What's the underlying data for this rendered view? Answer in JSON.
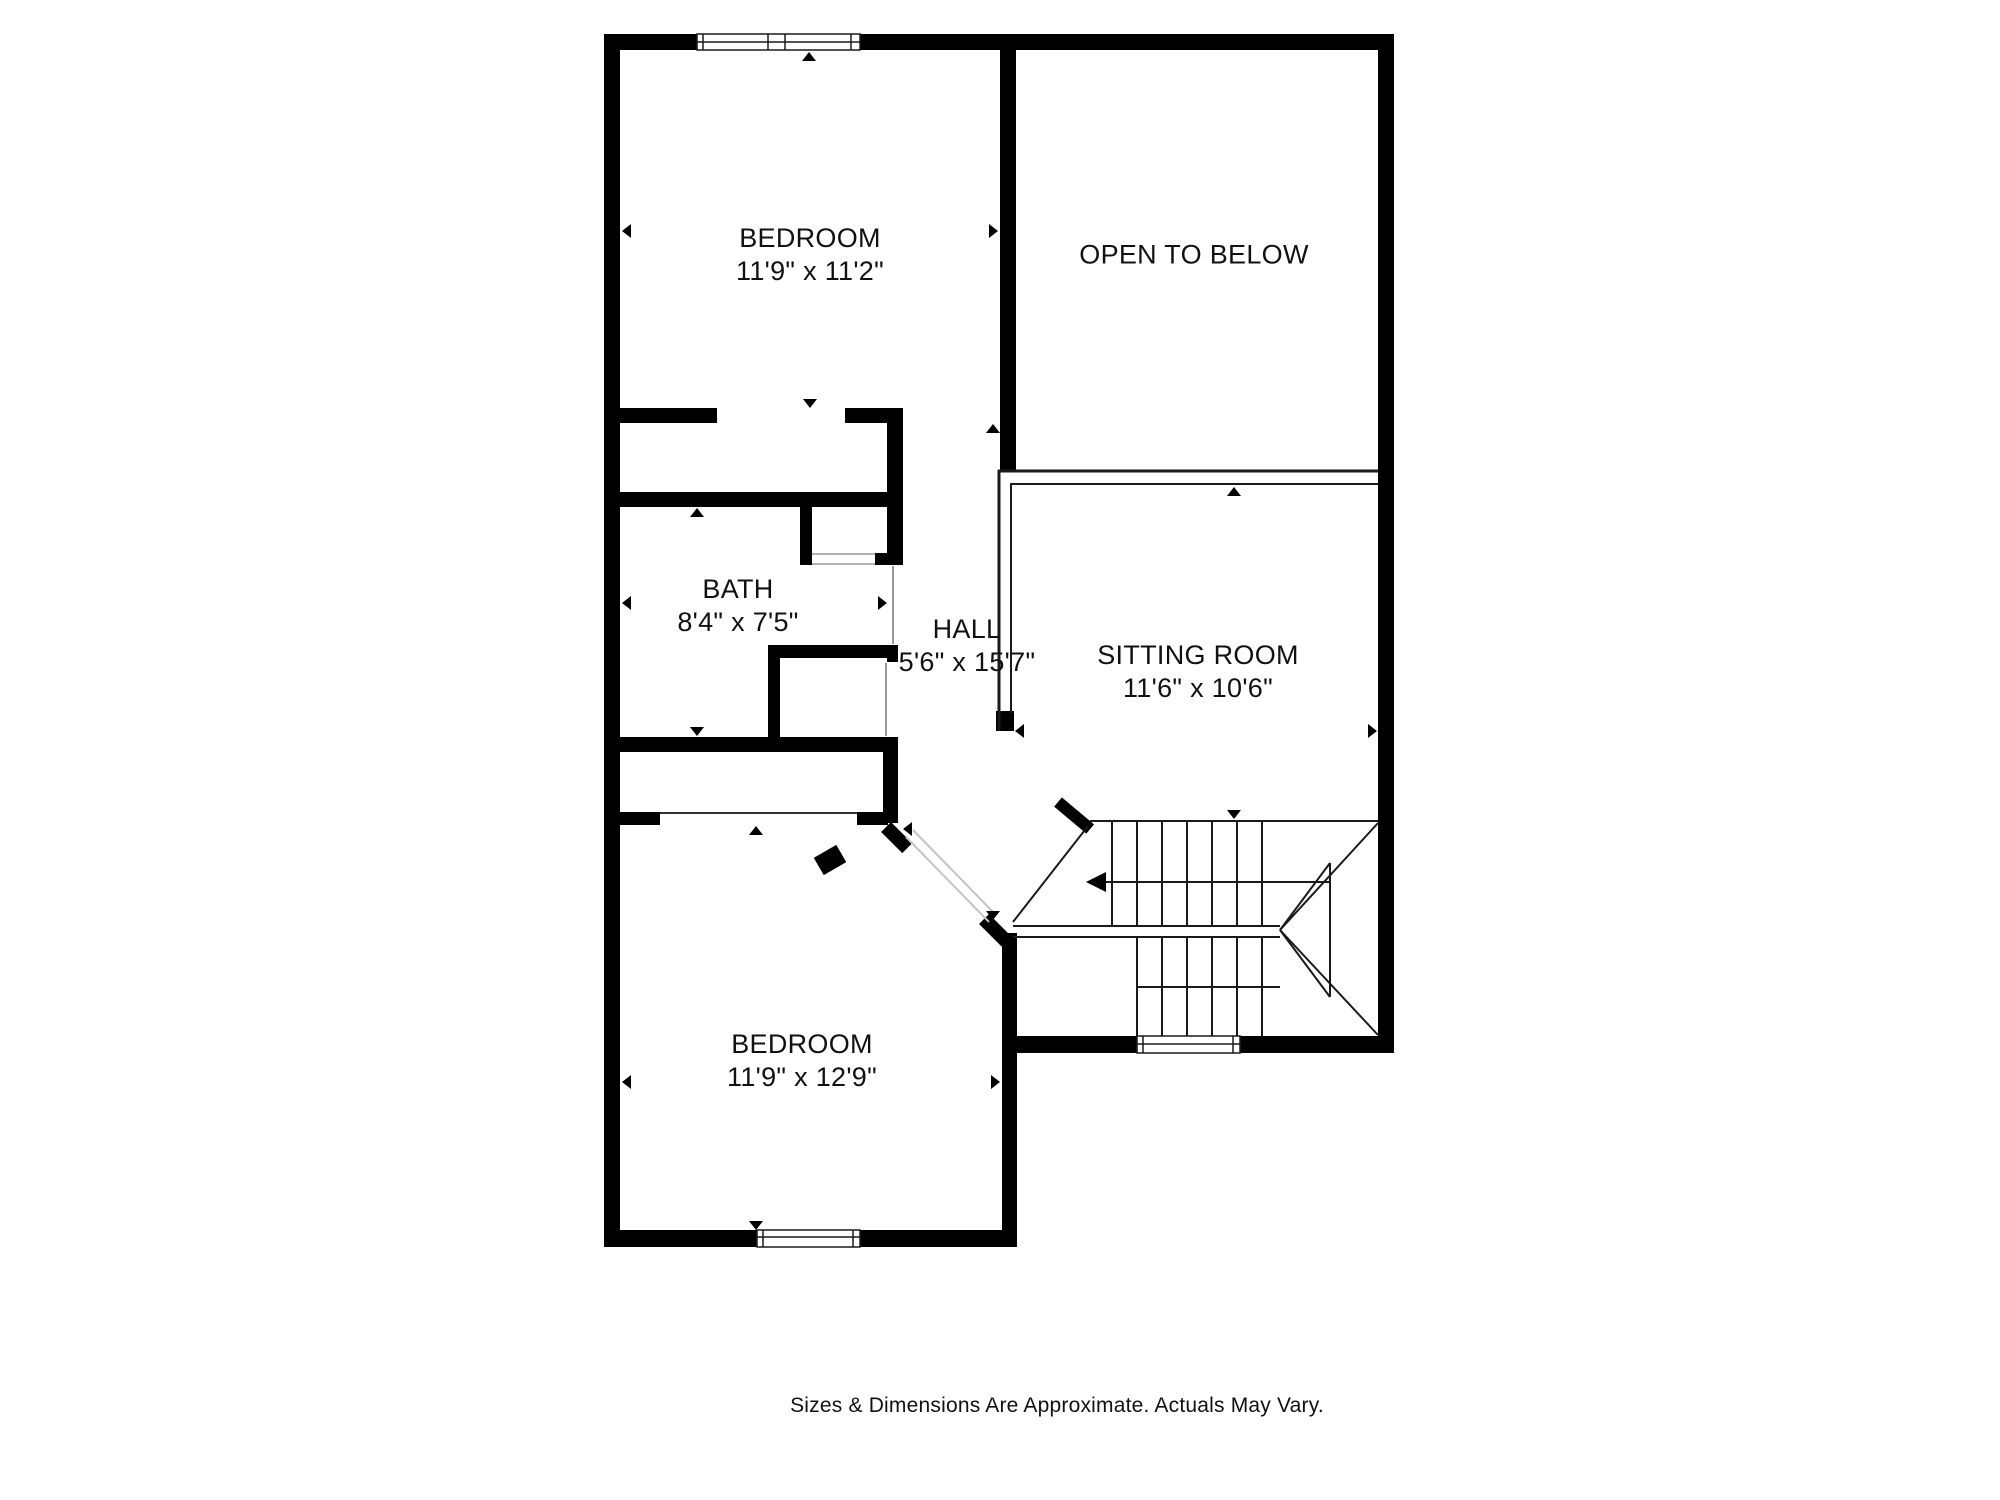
{
  "plan": {
    "type": "second-floor residential floor plan",
    "rooms": [
      {
        "id": "bedroom-top",
        "name": "BEDROOM",
        "dims": "11'9\" x 11'2\""
      },
      {
        "id": "open-to-below",
        "name": "OPEN TO BELOW",
        "dims": ""
      },
      {
        "id": "bath",
        "name": "BATH",
        "dims": "8'4\" x 7'5\""
      },
      {
        "id": "hall",
        "name": "HALL",
        "dims": "5'6\" x 15'7\""
      },
      {
        "id": "sitting-room",
        "name": "SITTING ROOM",
        "dims": "11'6\" x 10'6\""
      },
      {
        "id": "bedroom-bottom",
        "name": "BEDROOM",
        "dims": "11'9\" x 12'9\""
      }
    ],
    "features": [
      "stairs with winders",
      "railing at open-to-below",
      "3 windows",
      "2 closets",
      "angled bedroom entry"
    ],
    "footer": {
      "text": "Sizes & Dimensions Are Approximate. Actuals May Vary."
    },
    "colors": {
      "wall": "#000000",
      "line": "#1a1a1a",
      "opening_line": "#c4c4c4",
      "threshold_line": "#9a9a9a",
      "background": "#ffffff",
      "text": "#111111"
    }
  }
}
